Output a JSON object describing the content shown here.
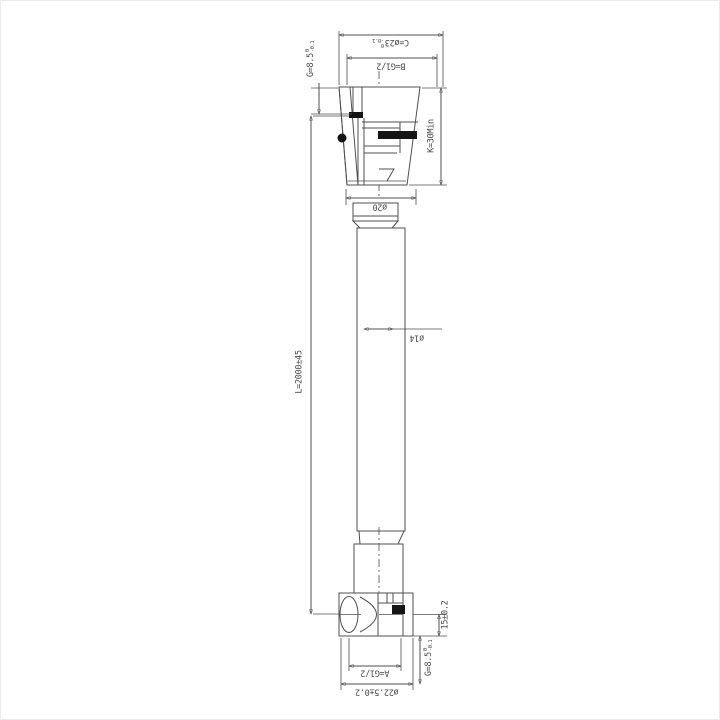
{
  "drawing": {
    "type": "technical-drawing",
    "subject": "flexible hose with end fittings",
    "colors": {
      "line": "#4f4f4f",
      "background": "#ffffff",
      "seal_fill": "#141414"
    },
    "labels": {
      "c_dim": {
        "text": "C=ø23",
        "tol_top": "0",
        "tol_bottom": "-0.1"
      },
      "b_dim": {
        "text": "B=G1/2"
      },
      "g_top": {
        "text": "G=8.5",
        "tol_top": "0",
        "tol_bottom": "-0.1"
      },
      "k_dim": {
        "text": "K=30Min"
      },
      "dia_20": {
        "text": "ø20"
      },
      "dia_14": {
        "text": "ø14"
      },
      "length": {
        "text": "L=2000±45"
      },
      "seat_15": {
        "text": "15±0.2"
      },
      "g_bottom": {
        "text": "G=8.5",
        "tol_top": "0",
        "tol_bottom": "-0.1"
      },
      "a_dim": {
        "text": "A=G1/2"
      },
      "dia_22_5": {
        "text": "ø22.5±0.2"
      }
    }
  }
}
